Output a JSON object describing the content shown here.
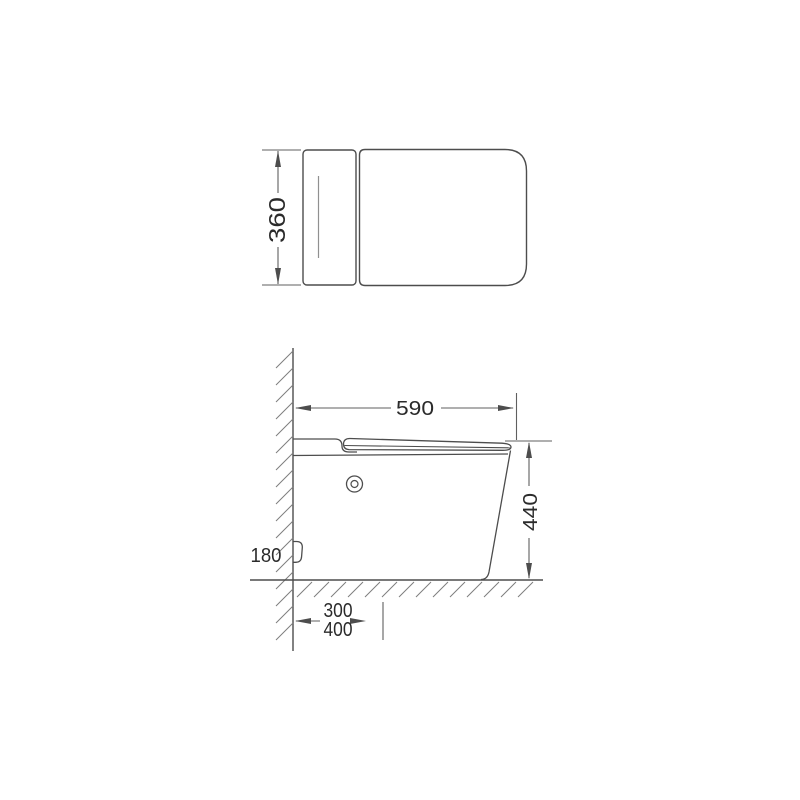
{
  "colors": {
    "outline": "#4d4d4d",
    "dimension": "#5f5f5f",
    "hatch": "#7e7e7e",
    "thin_line": "#909090",
    "text": "#2b2b2b",
    "background": "#ffffff"
  },
  "top_view": {
    "depth_label": "360"
  },
  "side_view": {
    "length_label": "590",
    "height_label": "440",
    "outlet_height_label": "180",
    "floor_offset_primary_label": "300",
    "floor_offset_secondary_label": "400"
  }
}
